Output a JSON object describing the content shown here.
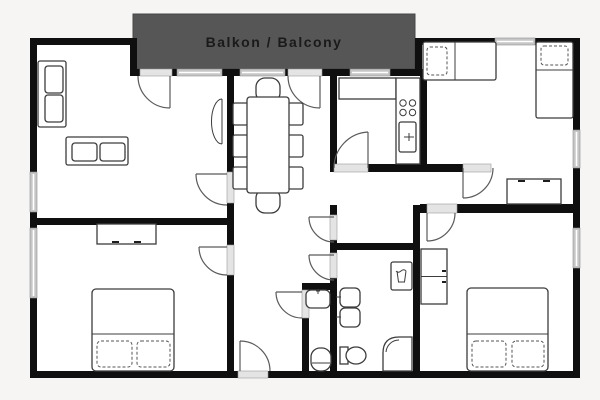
{
  "balcony": {
    "label": "Balkon / Balcony"
  },
  "colors": {
    "background": "#f6f5f3",
    "wall": "#0f0f0f",
    "floor": "#ffffff",
    "balcony_fill": "#565656",
    "balcony_text": "#1a1a1a",
    "window": "#c6c6c6",
    "furniture_outline": "#3c3c3c",
    "door_arc": "#5a5a5a"
  },
  "legend": {
    "furniture_symbols": [
      "sofa",
      "dining-table",
      "dining-chair",
      "kitchen-counter",
      "stove",
      "kitchen-sink",
      "single-bed",
      "double-bed",
      "pillow",
      "desk",
      "dresser",
      "wardrobe",
      "washing-machine",
      "bathroom-sink",
      "toilet",
      "shower",
      "wall-shelf",
      "door-swing",
      "window",
      "entrance-door"
    ]
  }
}
